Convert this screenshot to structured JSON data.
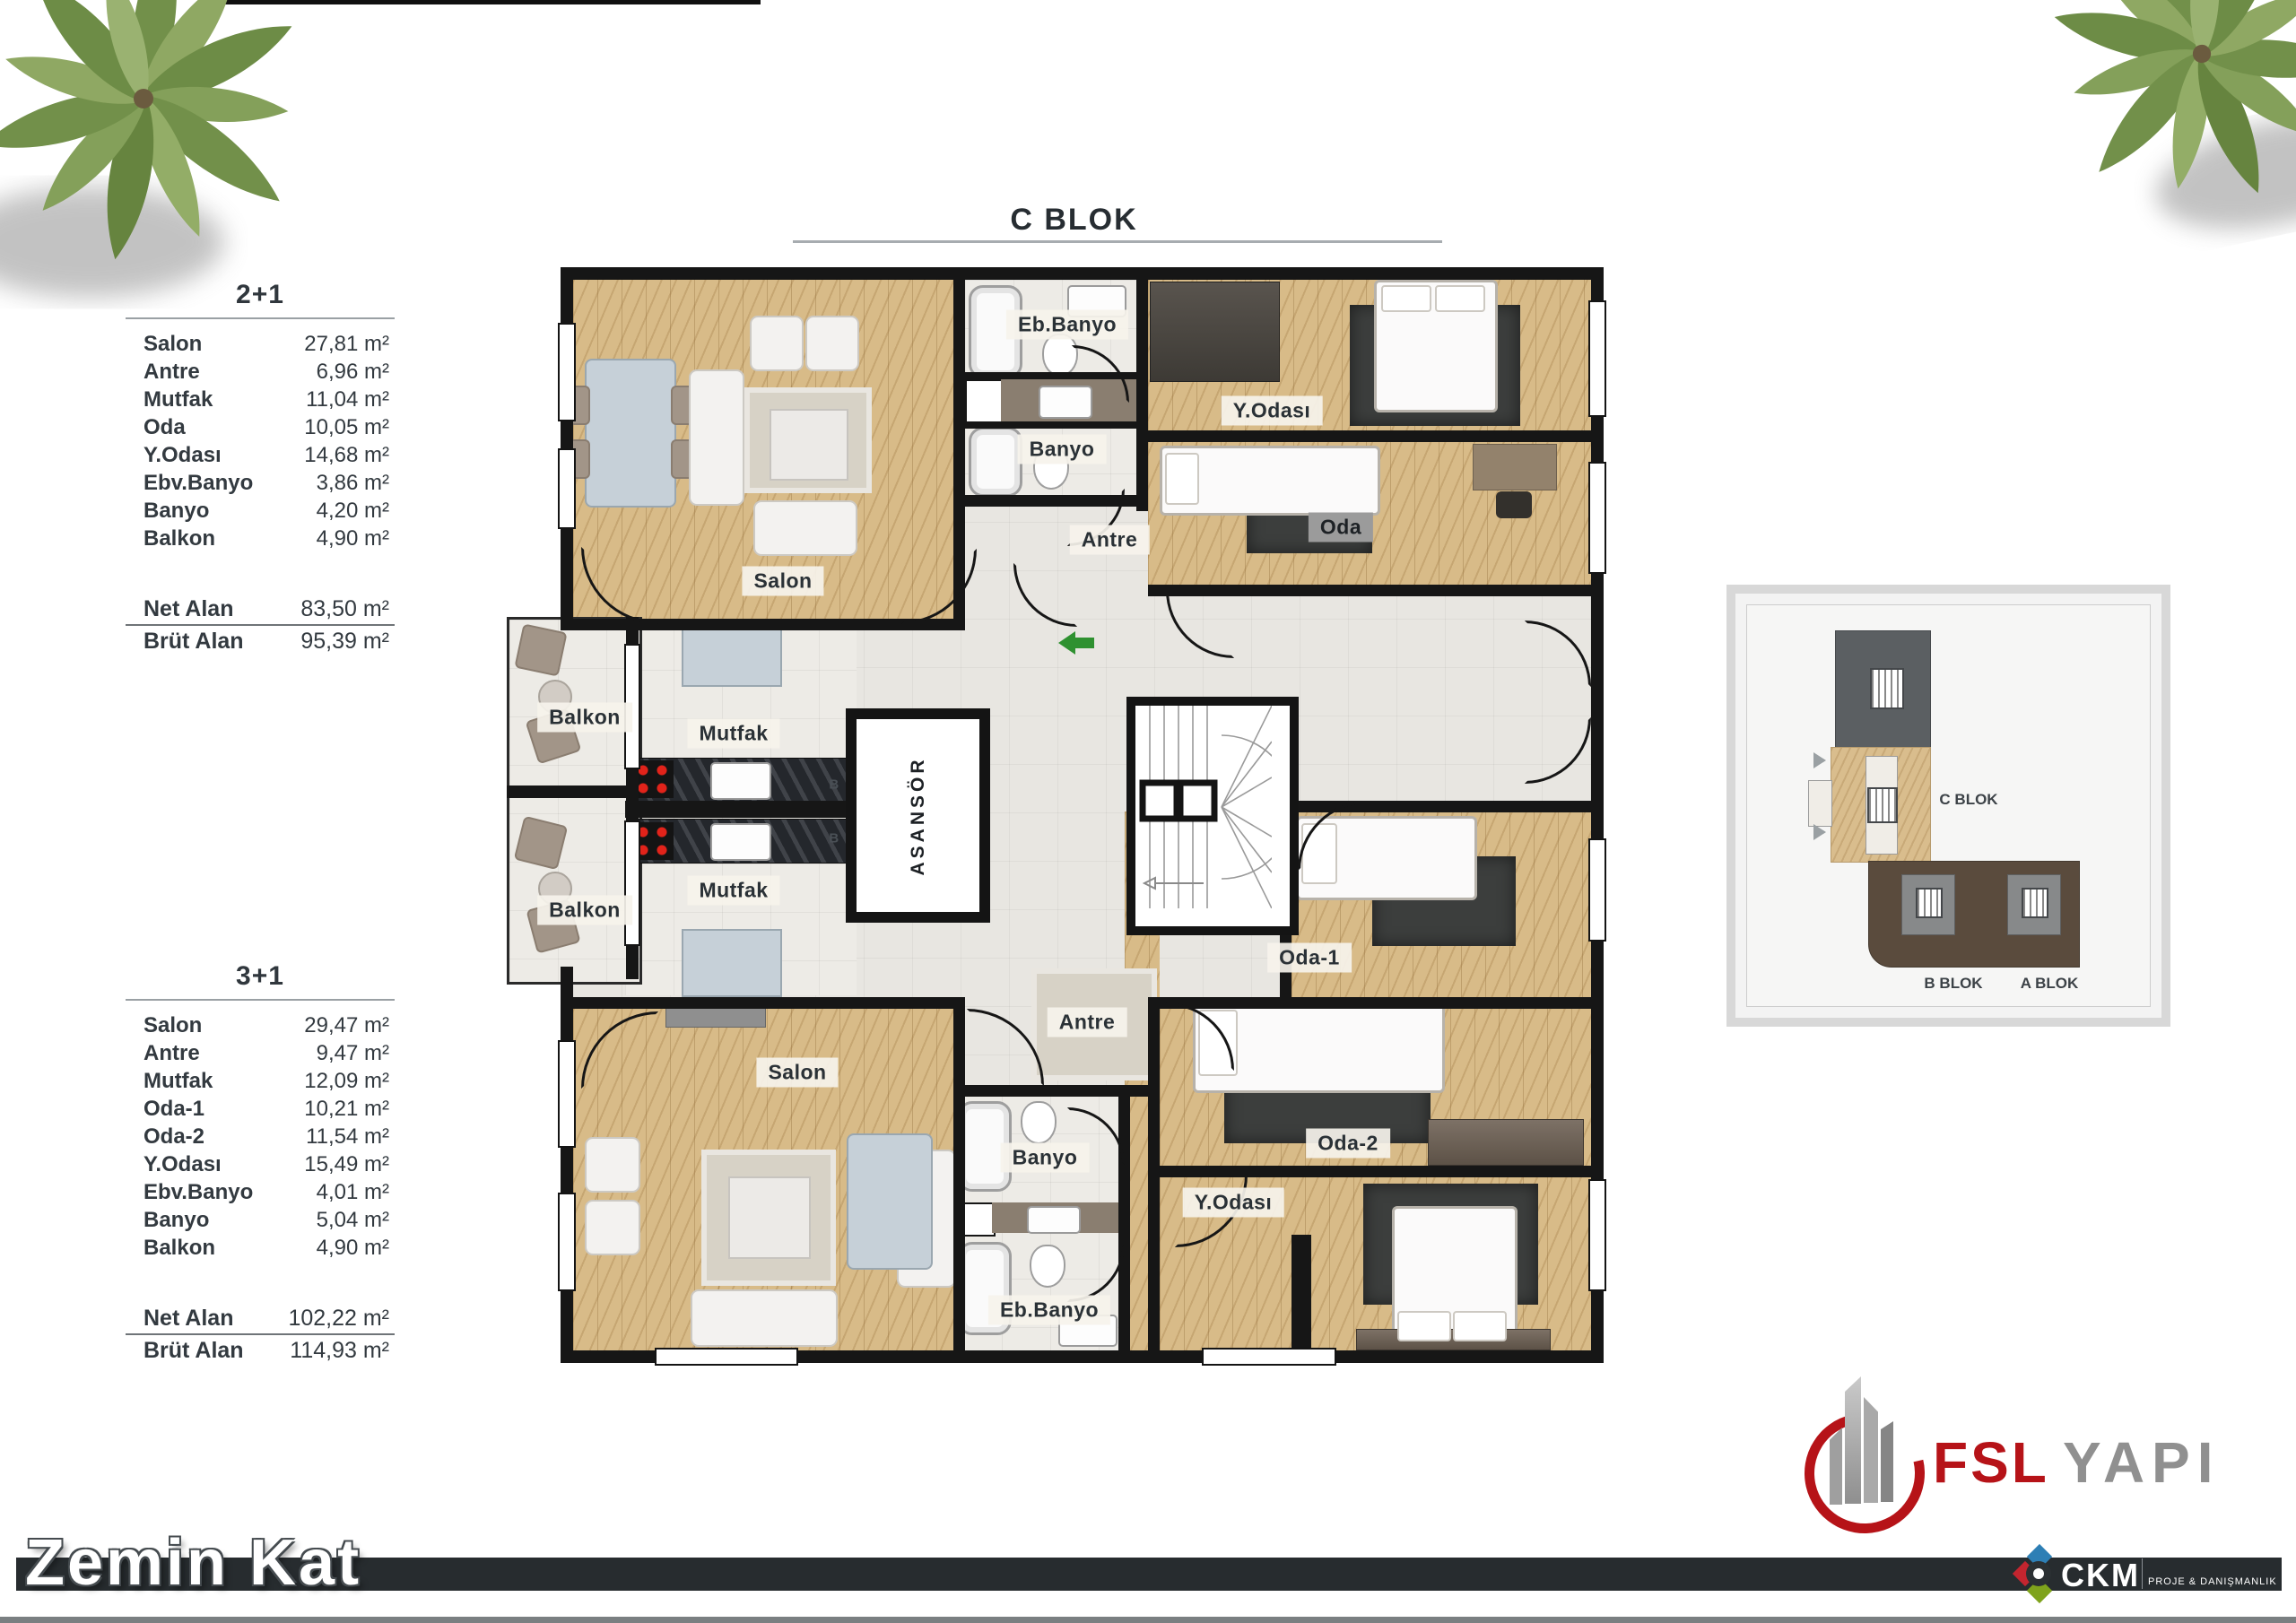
{
  "title": "C BLOK",
  "floor_label": "Zemin Kat",
  "units": {
    "u21": {
      "name": "2+1",
      "rows": [
        {
          "label": "Salon",
          "value": "27,81 m²"
        },
        {
          "label": "Antre",
          "value": "6,96 m²"
        },
        {
          "label": "Mutfak",
          "value": "11,04 m²"
        },
        {
          "label": "Oda",
          "value": "10,05 m²"
        },
        {
          "label": "Y.Odası",
          "value": "14,68 m²"
        },
        {
          "label": "Ebv.Banyo",
          "value": "3,86 m²"
        },
        {
          "label": "Banyo",
          "value": "4,20 m²"
        },
        {
          "label": "Balkon",
          "value": "4,90 m²"
        }
      ],
      "net": {
        "label": "Net Alan",
        "value": "83,50 m²"
      },
      "brut": {
        "label": "Brüt Alan",
        "value": "95,39 m²"
      }
    },
    "u31": {
      "name": "3+1",
      "rows": [
        {
          "label": "Salon",
          "value": "29,47 m²"
        },
        {
          "label": "Antre",
          "value": "9,47 m²"
        },
        {
          "label": "Mutfak",
          "value": "12,09 m²"
        },
        {
          "label": "Oda-1",
          "value": "10,21 m²"
        },
        {
          "label": "Oda-2",
          "value": "11,54 m²"
        },
        {
          "label": "Y.Odası",
          "value": "15,49 m²"
        },
        {
          "label": "Ebv.Banyo",
          "value": "4,01 m²"
        },
        {
          "label": "Banyo",
          "value": "5,04 m²"
        },
        {
          "label": "Balkon",
          "value": "4,90 m²"
        }
      ],
      "net": {
        "label": "Net Alan",
        "value": "102,22 m²"
      },
      "brut": {
        "label": "Brüt Alan",
        "value": "114,93 m²"
      }
    }
  },
  "plan": {
    "labels": {
      "salon_top": "Salon",
      "eb_banyo_top": "Eb.Banyo",
      "banyo_top": "Banyo",
      "antre_top": "Antre",
      "y_odasi_top": "Y.Odası",
      "oda_top": "Oda",
      "balkon_top": "Balkon",
      "mutfak_top": "Mutfak",
      "b_top": "B",
      "asansor": "ASANSÖR",
      "b_bottom": "B",
      "mutfak_bottom": "Mutfak",
      "balkon_bottom": "Balkon",
      "oda_1": "Oda-1",
      "antre_bottom": "Antre",
      "salon_bottom": "Salon",
      "oda_2": "Oda-2",
      "banyo_bottom": "Banyo",
      "y_odasi_bottom": "Y.Odası",
      "eb_banyo_bottom": "Eb.Banyo"
    }
  },
  "site_map": {
    "c_blok": "C BLOK",
    "b_blok": "B BLOK",
    "a_blok": "A BLOK"
  },
  "logos": {
    "fsl": {
      "name": "FSL",
      "suffix": "YAPI"
    },
    "ckm": {
      "name": "CKM",
      "tagline": "PROJE & DANIŞMANLIK"
    }
  },
  "colors": {
    "wall": "#161616",
    "wood": "#d8bb88",
    "footer_bar": "#272c2f",
    "fsl_red": "#b61318",
    "fsl_gray": "#909090",
    "ckm_blue": "#2e7fb5",
    "ckm_red": "#c4252f",
    "ckm_green": "#7fa31c",
    "ckm_dark": "#2b3033",
    "entrance_arrow_green": "#2f9130",
    "map_highlight_beige": "#d9bd8d",
    "map_block_gray": "#5b5f62",
    "map_block_brown": "#5a4b3d"
  }
}
